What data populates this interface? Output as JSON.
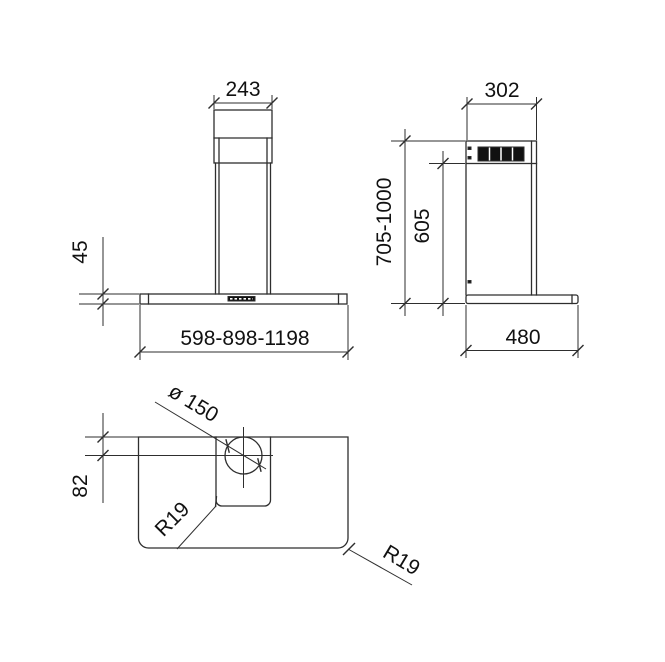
{
  "drawing": {
    "type": "technical-dimension-drawing",
    "views": {
      "front": {
        "chimney_width": "243",
        "body_height": "45",
        "width_range": "598-898-1198"
      },
      "side": {
        "depth": "302",
        "height_range": "705-1000",
        "upper_height": "605",
        "body_depth": "480"
      },
      "plan": {
        "duct_diameter": "ø 150",
        "duct_center_offset": "82",
        "inner_corner_radius": "R19",
        "outer_corner_radius": "R19"
      }
    },
    "colors": {
      "line": "#2e2e2e",
      "text": "#111111",
      "grille_fill": "#111111",
      "background": "#ffffff"
    }
  }
}
